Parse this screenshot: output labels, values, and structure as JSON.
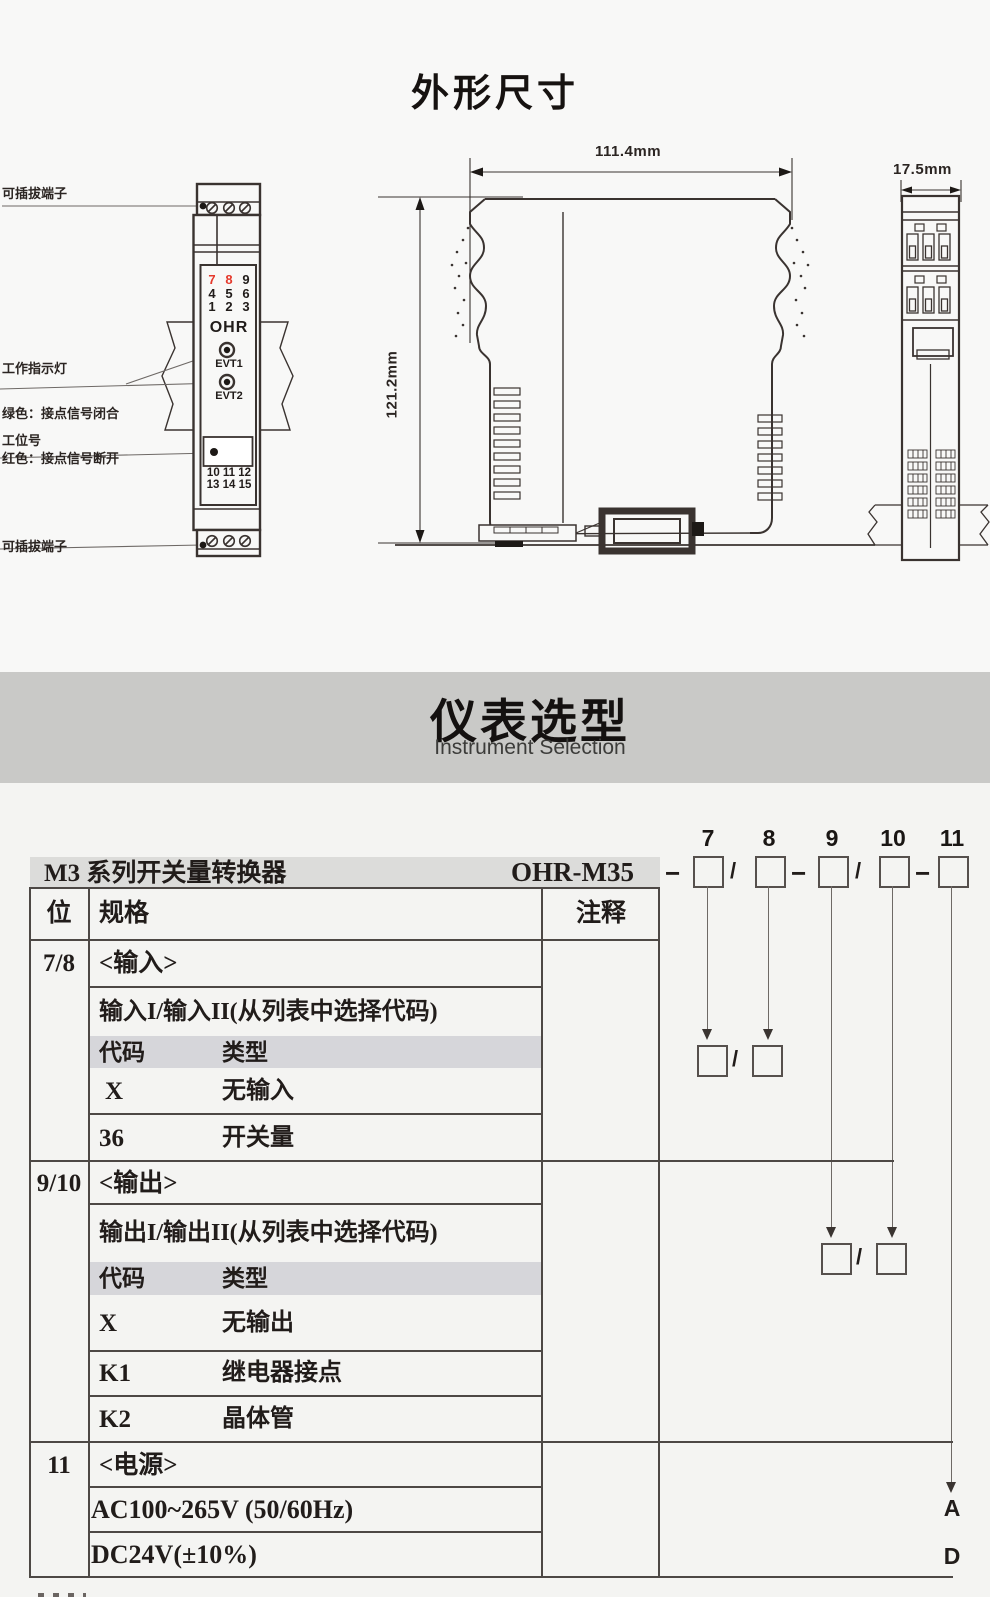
{
  "colors": {
    "accent_red": "#e5392c",
    "banner_bg": "#c9c9c7",
    "header_band_bg": "#dcdcda",
    "code_band_bg": "#d6d6da",
    "drawing_line": "#3a3330",
    "table_border": "#4d4845"
  },
  "dimensions_section": {
    "title": "外形尺寸",
    "front_view": {
      "label_top_terminal": "可插拔端子",
      "indicator_label": [
        "工作指示灯",
        "绿色：接点信号闭合",
        "红色：接点信号断开"
      ],
      "label_station_no": "工位号",
      "label_bottom_terminal": "可插拔端子",
      "terminals_top": [
        [
          "7",
          "8",
          "9"
        ],
        [
          "4",
          "5",
          "6"
        ],
        [
          "1",
          "2",
          "3"
        ]
      ],
      "brand": "OHR",
      "led1_label": "EVT1",
      "led2_label": "EVT2",
      "terminals_bottom": [
        "10 11 12",
        "13 14 15"
      ]
    },
    "side_view": {
      "width_dim": "111.4mm",
      "height_dim": "121.2mm"
    },
    "end_view": {
      "width_dim": "17.5mm"
    }
  },
  "selection_section": {
    "banner_title": "仪表选型",
    "banner_subtitle": "Instrument Selection",
    "series_title": "M3 系列开关量转换器",
    "model_code": "OHR-M35",
    "digit_labels": [
      "7",
      "8",
      "9",
      "10",
      "11"
    ],
    "separators": [
      "−",
      "/",
      "−",
      "/",
      "−"
    ],
    "pair_slash": "/",
    "table": {
      "col_pos": "位",
      "col_spec": "规格",
      "col_note": "注释",
      "groups": [
        {
          "pos": "7/8",
          "name": "<输入>",
          "subtitle": "输入I/输入II(从列表中选择代码)",
          "code_col": "代码",
          "type_col": "类型",
          "options": [
            {
              "code": "X",
              "type": "无输入"
            },
            {
              "code": "36",
              "type": "开关量"
            }
          ]
        },
        {
          "pos": "9/10",
          "name": "<输出>",
          "subtitle": "输出I/输出II(从列表中选择代码)",
          "code_col": "代码",
          "type_col": "类型",
          "options": [
            {
              "code": "X",
              "type": "无输出"
            },
            {
              "code": "K1",
              "type": "继电器接点"
            },
            {
              "code": "K2",
              "type": "晶体管"
            }
          ]
        },
        {
          "pos": "11",
          "name": "<电源>",
          "options": [
            {
              "type": "AC100~265V (50/60Hz)",
              "code_right": "A"
            },
            {
              "type": "DC24V(±10%)",
              "code_right": "D"
            }
          ]
        }
      ]
    }
  }
}
